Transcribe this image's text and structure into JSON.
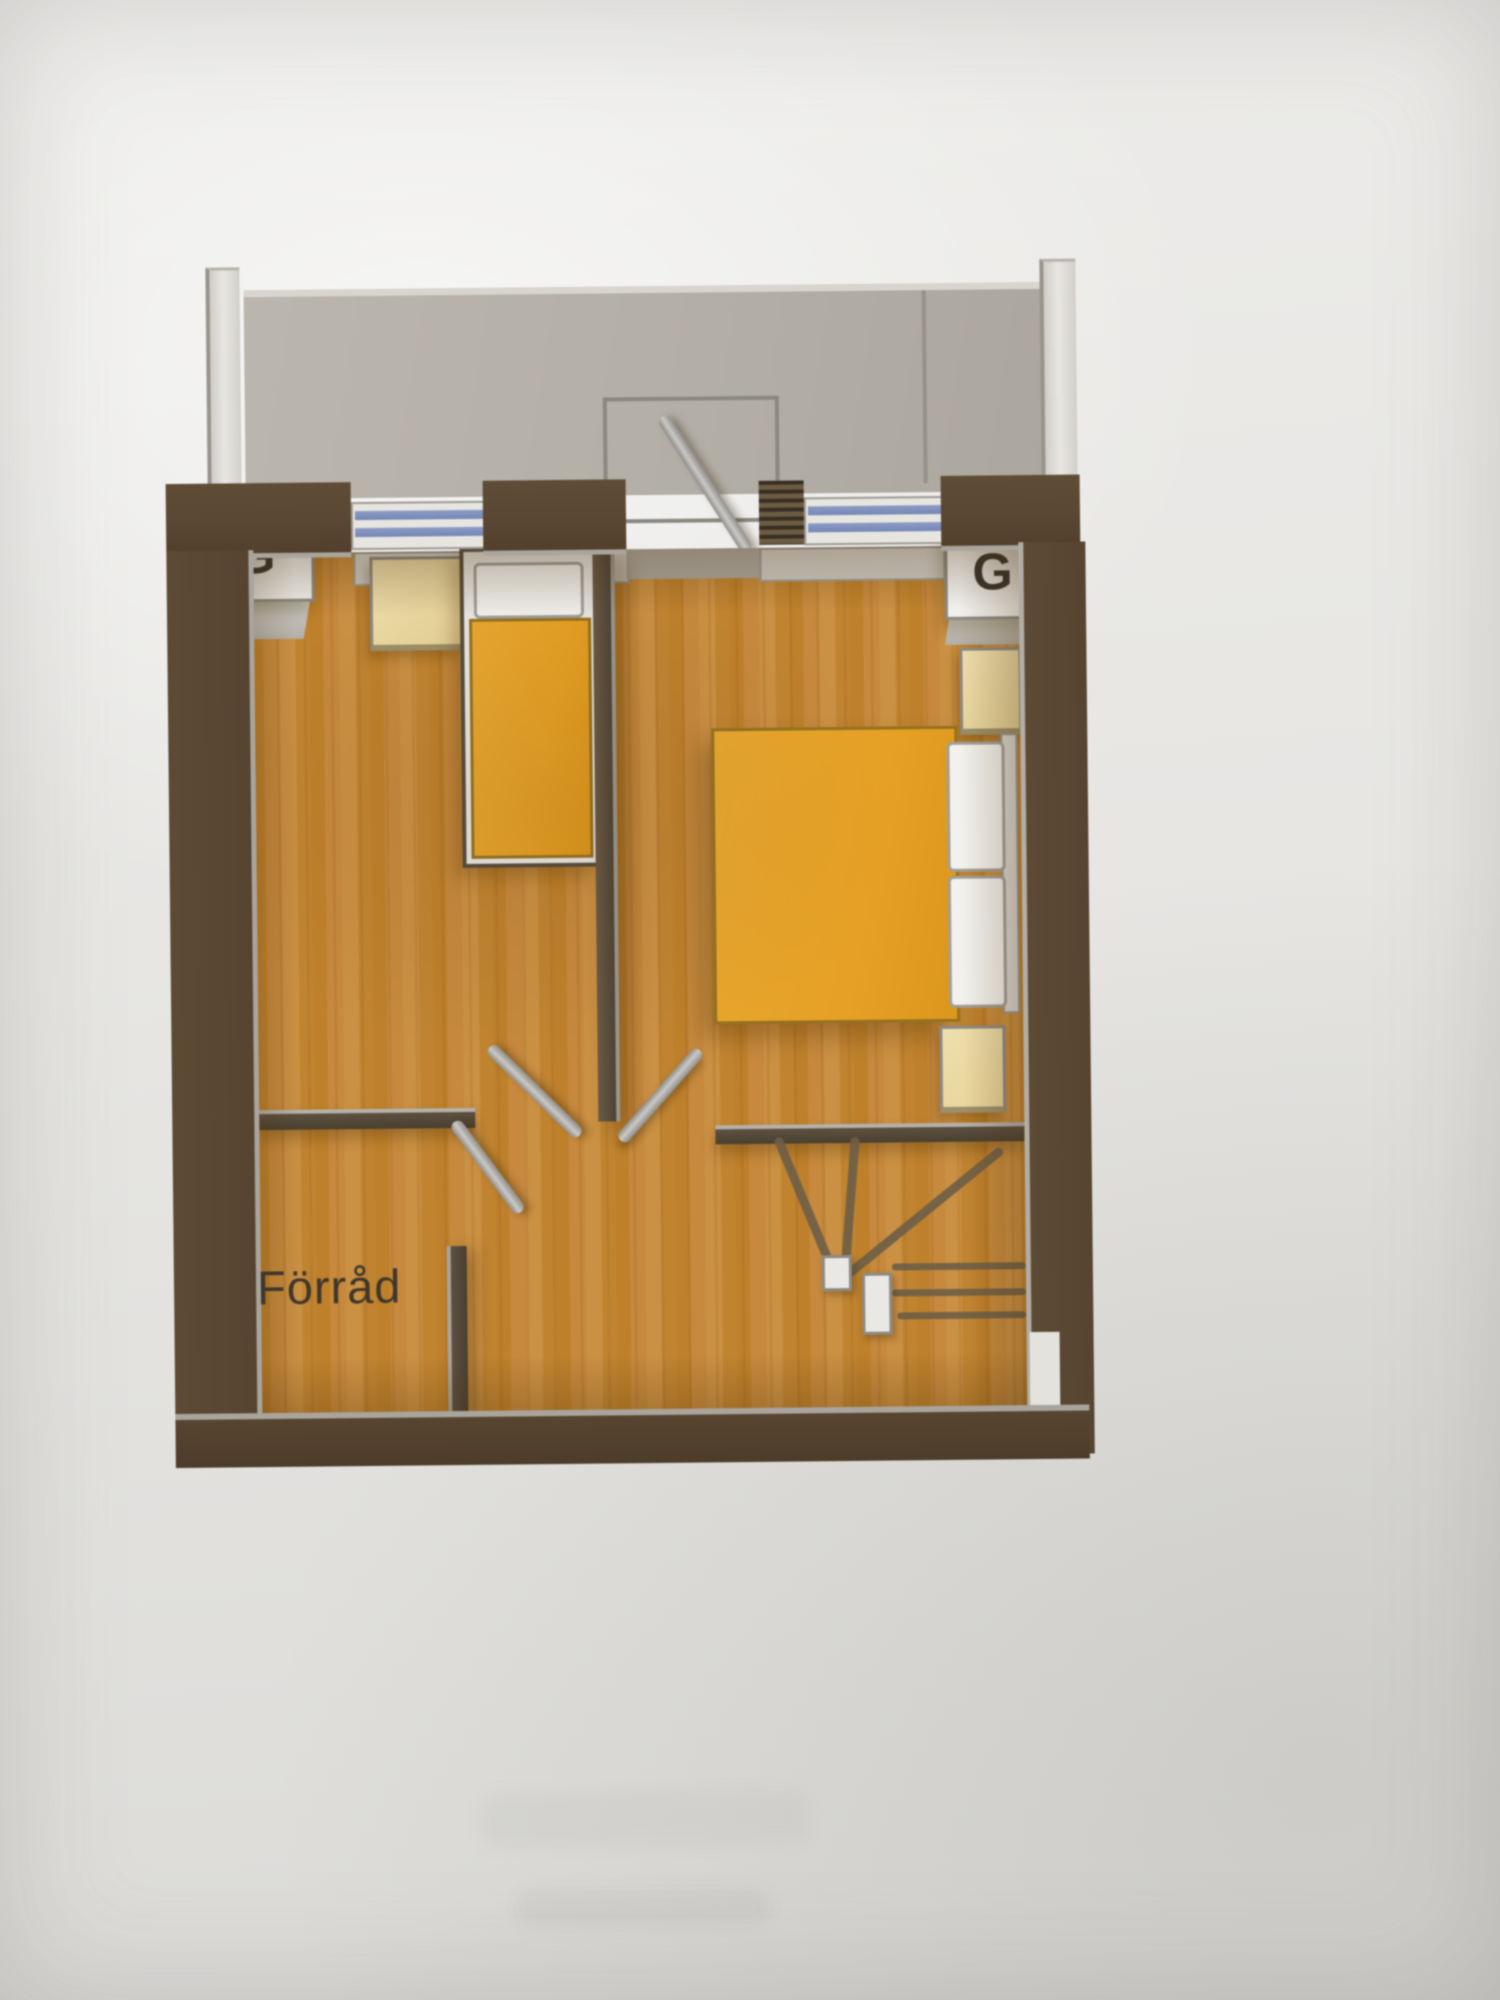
{
  "floorplan": {
    "storage_label": "Förråd",
    "wardrobe_left_label": "G",
    "wardrobe_right_label": "G",
    "colors": {
      "paper": "#e8e7e4",
      "wall_brown": "#594732",
      "wall_inner_line": "#aaa69e",
      "floor_wood": "#c78a33",
      "balcony_floor": "#b3aea6",
      "railing_white": "#e2e0db",
      "window_glass_blue": "#7e90bd",
      "window_frame_white": "#e6e4df",
      "door_leaf_gray": "#a8a6a2",
      "mattress_orange": "#e7a121",
      "bed_frame_white": "#eae8e4",
      "pillow_white": "#f1f0ec",
      "nightstand_beige": "#ebd8a1",
      "wardrobe_box_white": "#f1f0ed",
      "label_text": "#3f362a"
    }
  }
}
